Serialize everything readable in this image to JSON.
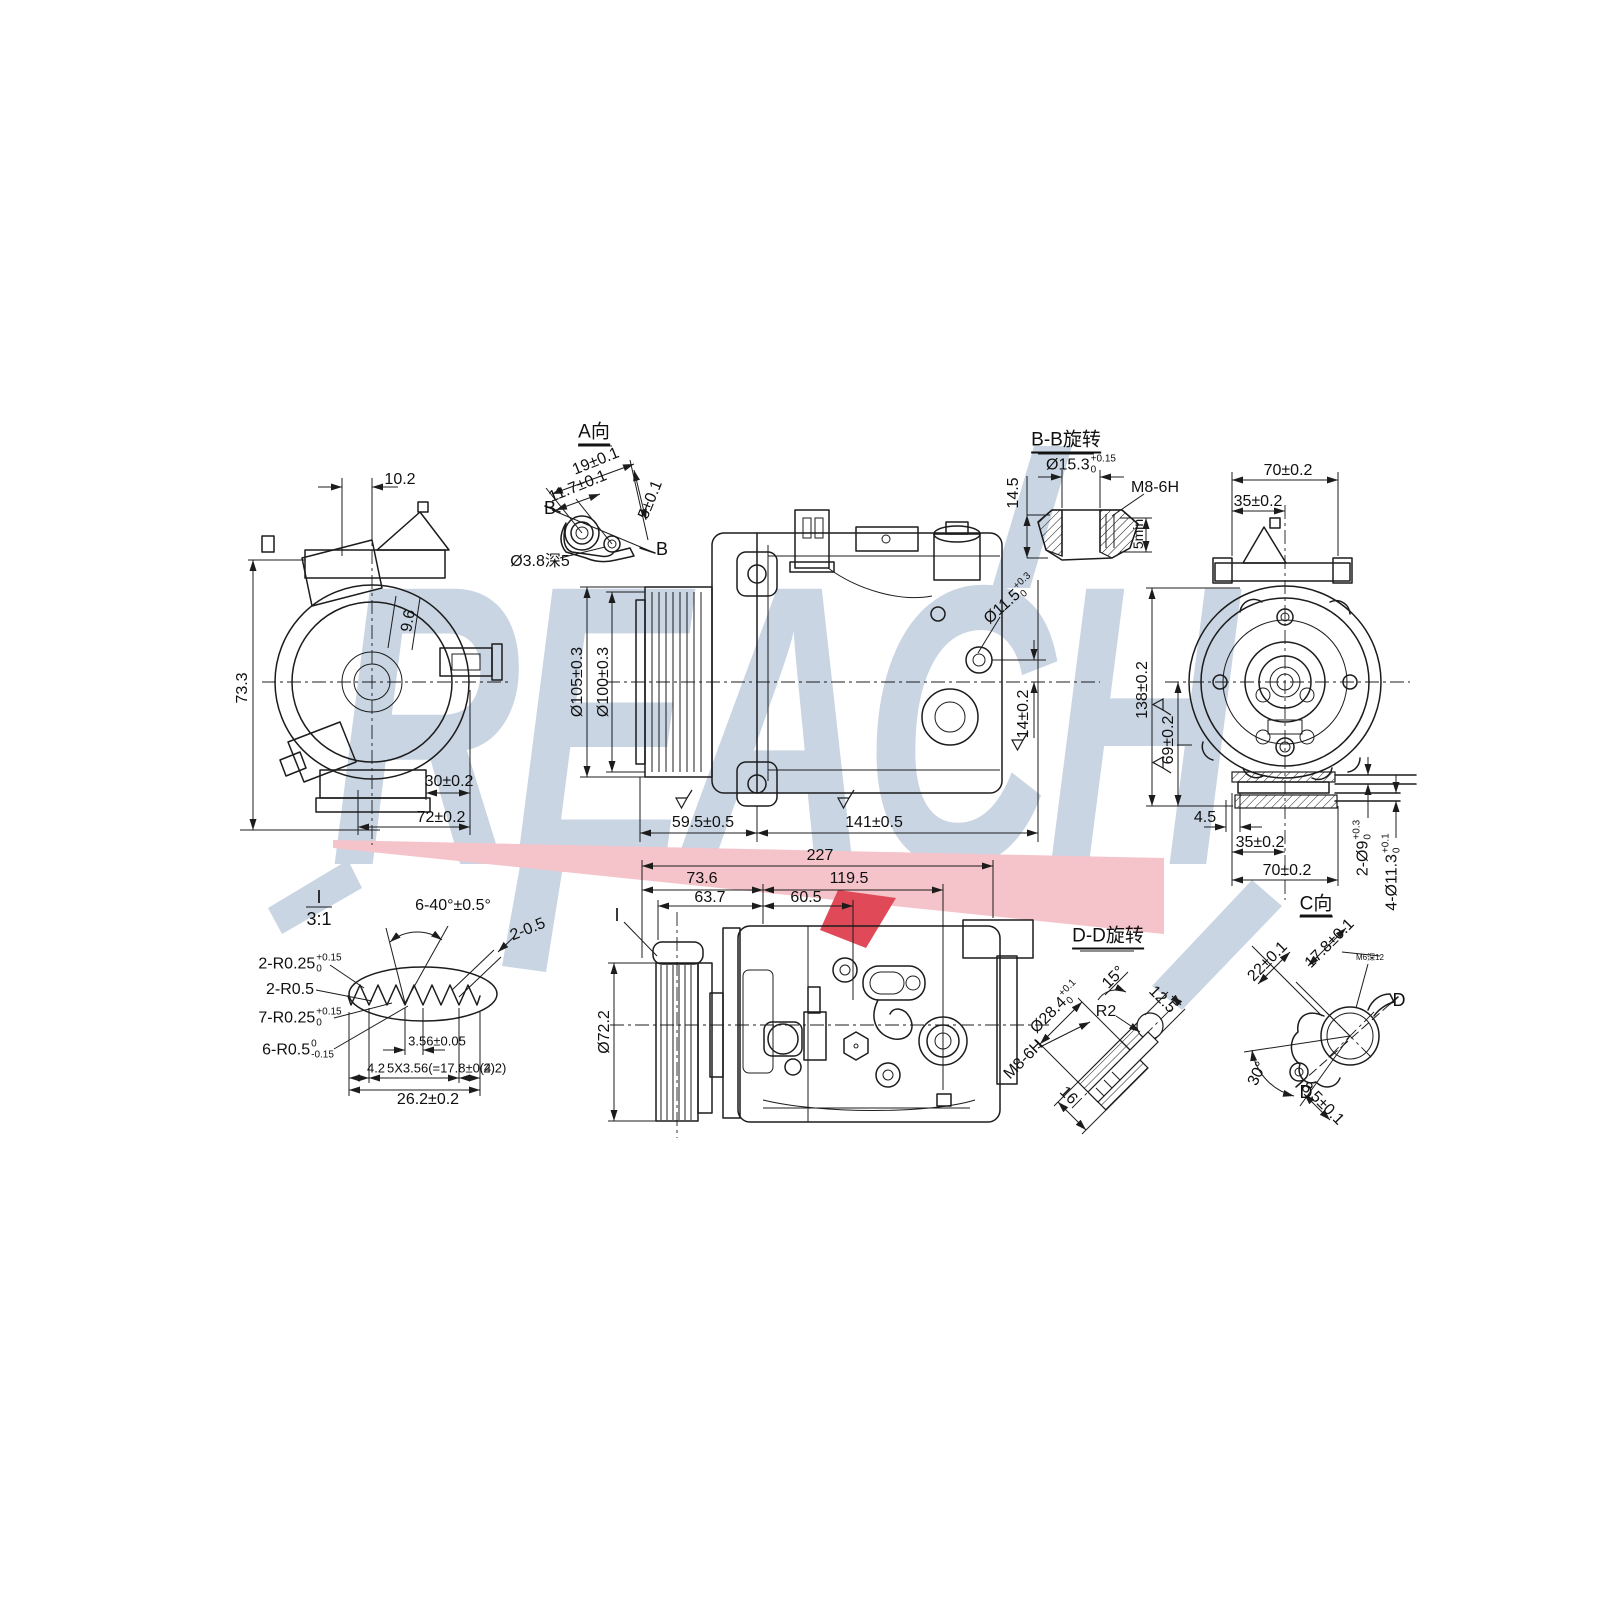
{
  "watermark": {
    "text": "REACH"
  },
  "colors": {
    "letters": "#c9d5e3",
    "pink": "#f5c3ca",
    "red": "#e04a58",
    "line": "#1c1c1c"
  },
  "left_view": {
    "width_top": "10.2",
    "height": "73.3",
    "offset": "9.6",
    "foot": "30±0.2",
    "base": "72±0.2"
  },
  "detail_a": {
    "label": "A向",
    "d19": "19±0.1",
    "d117": "11.7±0.1",
    "d5": "5±0.1",
    "b1": "B",
    "b2": "B",
    "hole": "Ø3.8深5"
  },
  "front_view": {
    "pulley_od": "Ø105±0.3",
    "pulley_pd": "Ø100±0.3",
    "len1": "59.5±0.5",
    "len2": "141±0.5",
    "port": {
      "b": "Ø11.5",
      "u": "+0.3",
      "d": "0"
    },
    "offset": "14±0.2"
  },
  "section_bb": {
    "label": "B-B旋转",
    "bore": {
      "b": "Ø15.3",
      "u": "+0.15",
      "d": "0"
    },
    "thread": "M8-6H",
    "height": "14.5",
    "depth": "5min"
  },
  "rear_view": {
    "top_w": "70±0.2",
    "top_half": "35±0.2",
    "height": "138±0.2",
    "half_h": "69±0.2",
    "foot_off": "4.5",
    "bot_half": "35±0.2",
    "bot_w": "70±0.2",
    "holes2": {
      "b": "2-Ø9",
      "u": "+0.3",
      "d": "0"
    },
    "holes4": {
      "b": "4-Ø11.3",
      "u": "+0.1",
      "d": "0"
    },
    "label_c": "C向"
  },
  "detail_i": {
    "num": "I",
    "scale": "3:1",
    "angle": "6-40°±0.5°",
    "tip": "2-0.5",
    "r1": {
      "b": "2-R0.25",
      "u": "+0.15",
      "d": "0"
    },
    "r2": "2-R0.5",
    "r3": {
      "b": "7-R0.25",
      "u": "+0.15",
      "d": "0"
    },
    "r4": {
      "b": "6-R0.5",
      "u": "0",
      "d": "-0.15"
    },
    "pitch": "3.56±0.05",
    "left": "4.2",
    "pitches": "5X3.56(=17.8±0.2)",
    "right": "(4.2)",
    "total": "26.2±0.2"
  },
  "bottom_view": {
    "total": "227",
    "l1": "73.6",
    "l2": "119.5",
    "l3": "63.7",
    "l4": "60.5",
    "pulley": "Ø72.2",
    "detail_ref": "I",
    "thread": "M8-6H"
  },
  "section_dd": {
    "label": "D-D旋转",
    "bore": {
      "b": "Ø28.4",
      "u": "+0.1",
      "d": "0"
    },
    "angle": "15°",
    "radius": "R2",
    "d125": "12.5",
    "d16": "16"
  },
  "view_c": {
    "d22": "22±0.1",
    "d178": "17.8±0.1",
    "small": "M6深12",
    "d_top": "D",
    "d_bot": "D",
    "angle": "30°",
    "d85": "8.5±0.1"
  }
}
